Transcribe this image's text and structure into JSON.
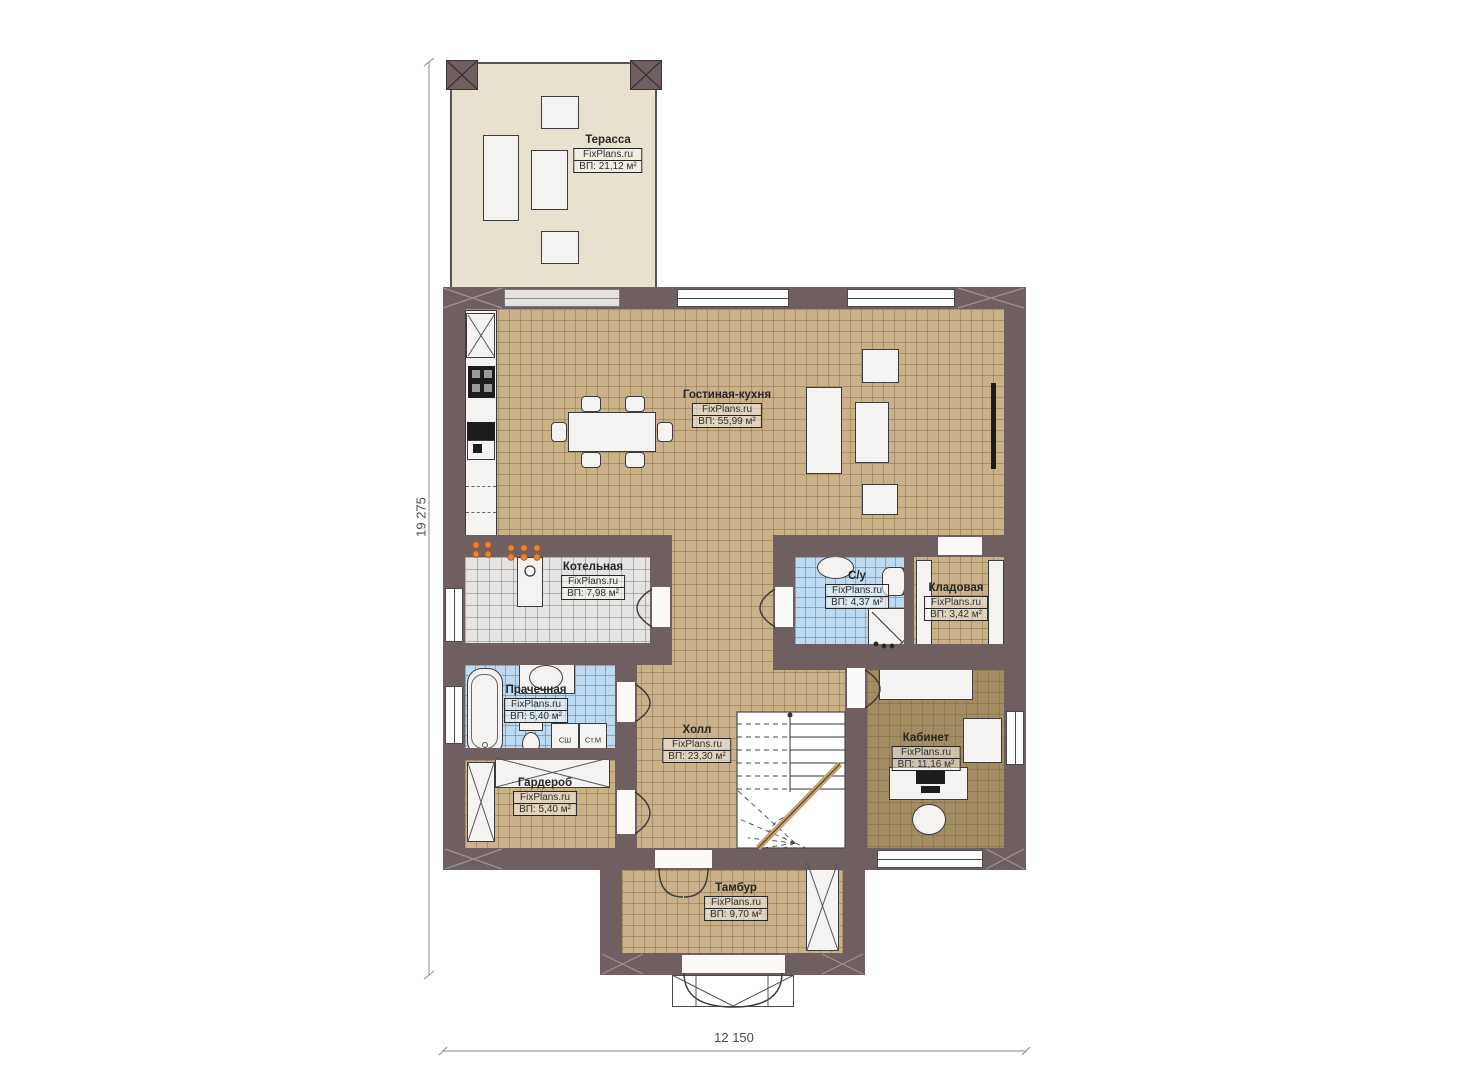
{
  "plan": {
    "brand": "FixPlans.ru",
    "rooms": [
      {
        "name": "Терасса",
        "area": "ВП: 21,12 м²"
      },
      {
        "name": "Гостиная-кухня",
        "area": "ВП: 55,99 м²"
      },
      {
        "name": "Котельная",
        "area": "ВП: 7,98 м²"
      },
      {
        "name": "С/у",
        "area": "ВП: 4,37 м²"
      },
      {
        "name": "Кладовая",
        "area": "ВП: 3,42 м²"
      },
      {
        "name": "Прачечная",
        "area": "ВП: 5,40 м²"
      },
      {
        "name": "Холл",
        "area": "ВП: 23,30 м²"
      },
      {
        "name": "Кабинет",
        "area": "ВП: 11,16 м²"
      },
      {
        "name": "Гардероб",
        "area": "ВП: 5,40 м²"
      },
      {
        "name": "Тамбур",
        "area": "ВП: 9,70 м²"
      }
    ],
    "appliances": {
      "dryer": "СШ",
      "washer": "Ст.М"
    },
    "dimensions": {
      "vertical": "19 275",
      "horizontal": "12 150"
    }
  }
}
